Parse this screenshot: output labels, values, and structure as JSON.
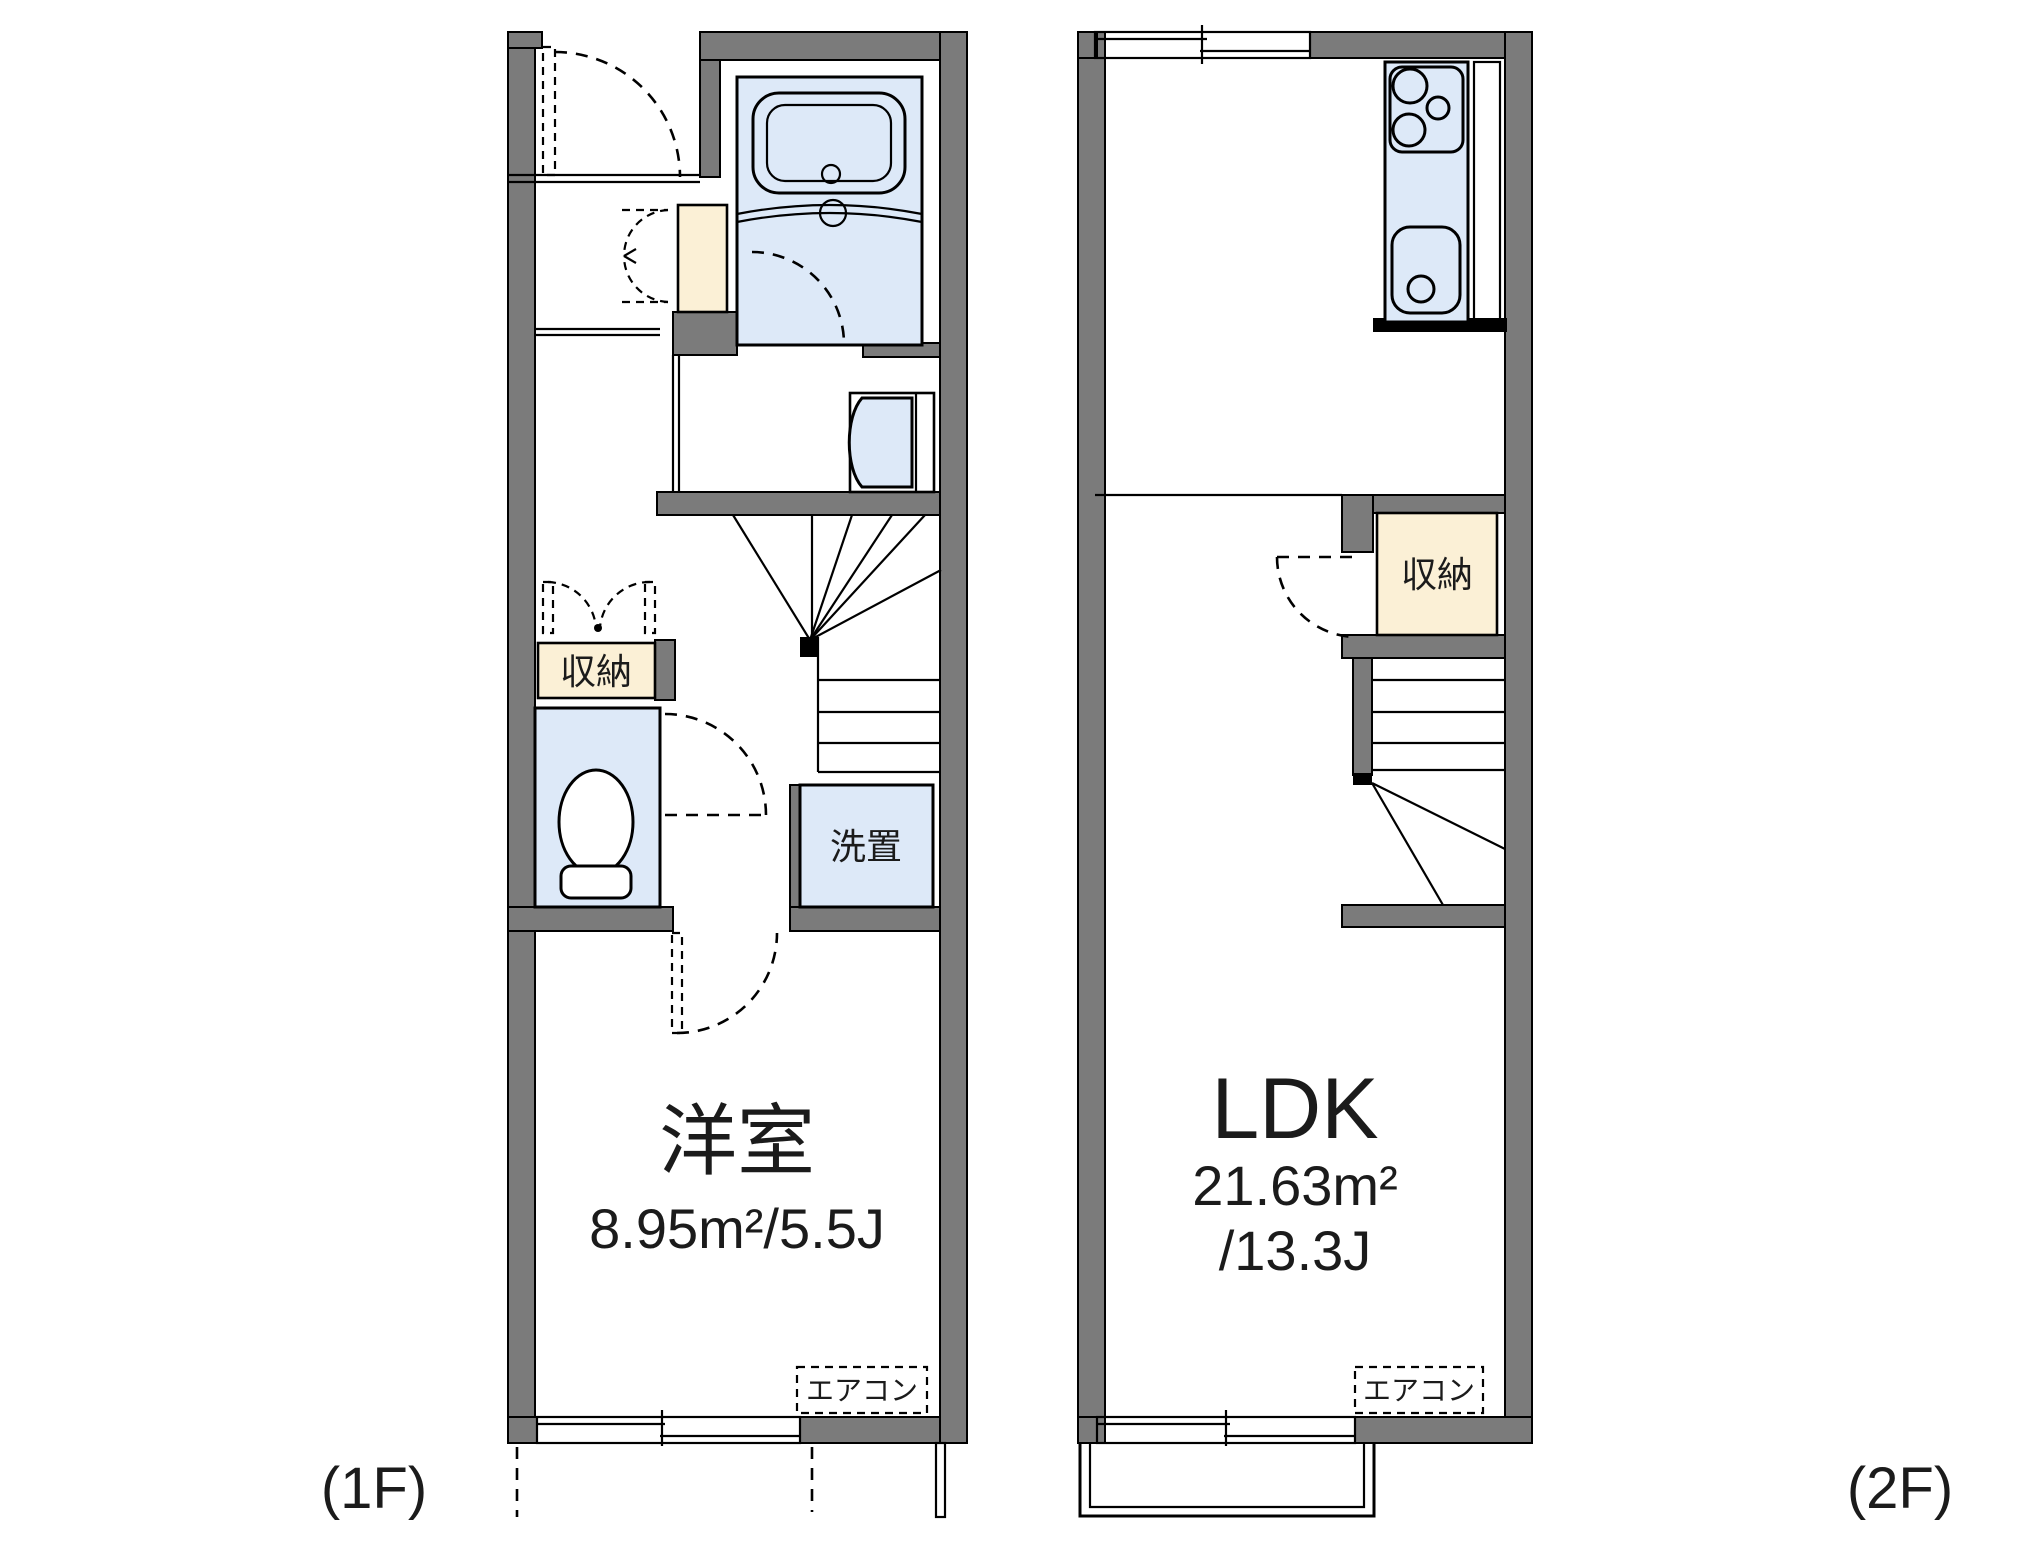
{
  "document_type": "apartment-floor-plan",
  "floors": {
    "f1": {
      "label": "(1F)",
      "room_name": "洋室",
      "room_area": "8.95m²/5.5J",
      "storage": "収納",
      "laundry": "洗置",
      "aircon": "エアコン"
    },
    "f2": {
      "label": "(2F)",
      "room_name": "LDK",
      "room_area_m2": "21.63m²",
      "room_area_j": "/13.3J",
      "storage": "収納",
      "aircon": "エアコン"
    }
  },
  "colors": {
    "wall": "#7b7b7b",
    "fixture_fill": "#dde9f8",
    "storage_fill": "#fbf0d6",
    "line": "#000000",
    "background": "#ffffff"
  }
}
